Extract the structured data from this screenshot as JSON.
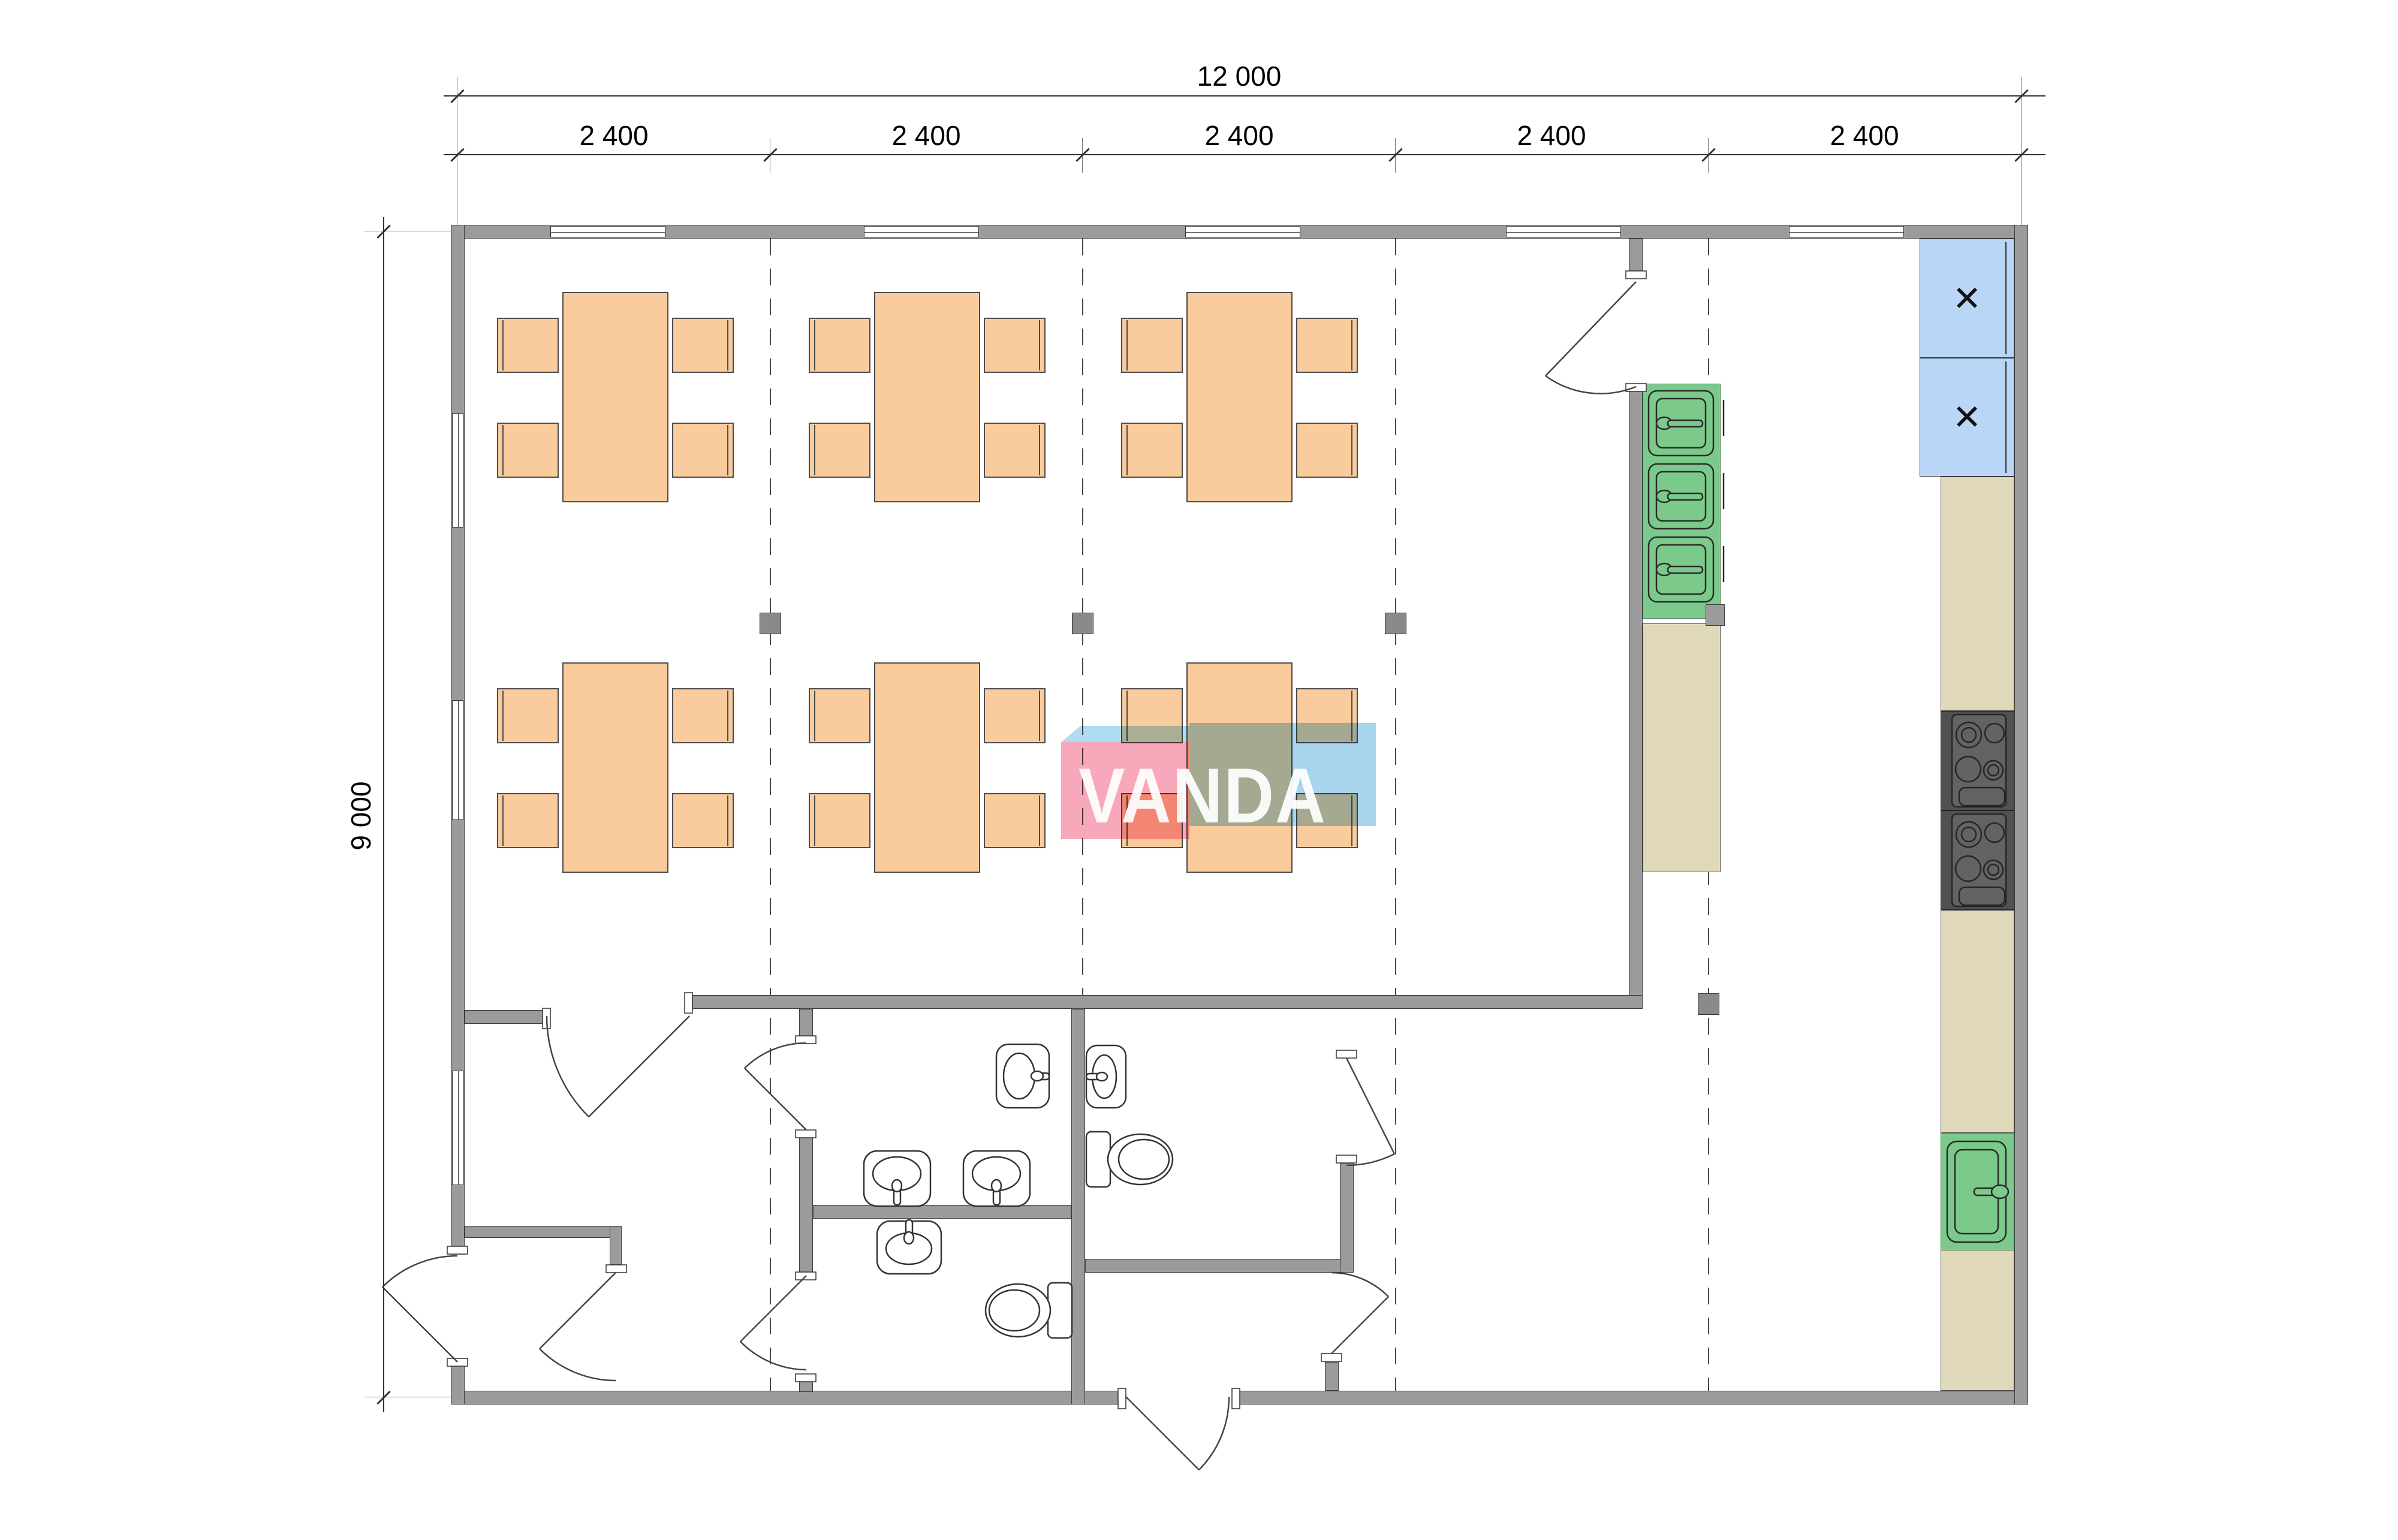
{
  "drawing": {
    "type": "floor-plan",
    "dimensions": {
      "total_width_label": "12 000",
      "bay_labels": [
        "2 400",
        "2 400",
        "2 400",
        "2 400",
        "2 400"
      ],
      "total_height_label": "9 000"
    },
    "watermark": {
      "text": "VANDA"
    },
    "kitchen": {
      "stove_label": "ПЭ",
      "fridge_mark": "✕",
      "stove_count": 2,
      "fridge_count": 2,
      "kitchen_sink_count": 3,
      "wall_sink_count": 1
    },
    "rooms": {
      "dining_tables": 6,
      "chairs_per_table": 4,
      "wash_basins": 5,
      "toilets": 2
    },
    "colors": {
      "wall": "#9B9B9B",
      "furniture": "#FACB9C",
      "sink_green": "#7CC98C",
      "counter_tan": "#DFD9B9",
      "fridge_blue": "#B9D6F6",
      "stove_dark": "#515151",
      "stove_text_orange": "#E8821C",
      "logo_pink": "#F7A8BA",
      "logo_blue": "#A8D4EE"
    }
  },
  "furniture": {
    "table_size": [
      177,
      351
    ],
    "chair_size": [
      103,
      92
    ],
    "tables": [
      [
        938,
        487
      ],
      [
        1458,
        487
      ],
      [
        1979,
        487
      ],
      [
        938,
        1105
      ],
      [
        1458,
        1105
      ],
      [
        1979,
        1105
      ]
    ],
    "chair_offsets": [
      [
        -109,
        43,
        "l"
      ],
      [
        -109,
        218,
        "l"
      ],
      [
        183,
        43,
        "r"
      ],
      [
        183,
        218,
        "r"
      ]
    ]
  }
}
